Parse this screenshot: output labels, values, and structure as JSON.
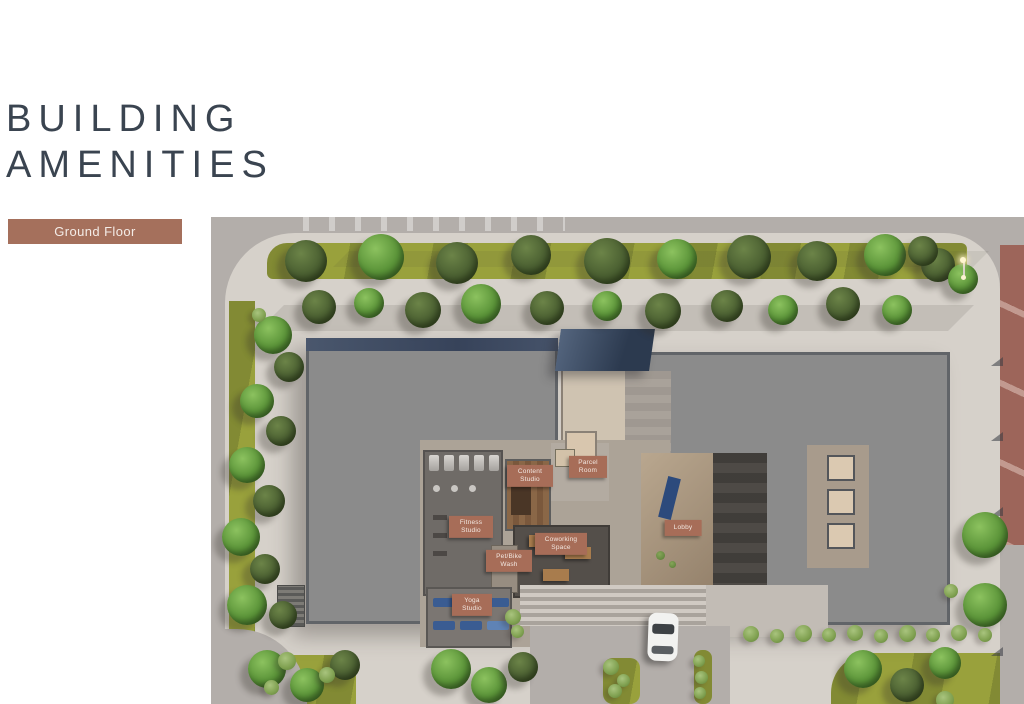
{
  "header": {
    "title_line1": "BUILDING",
    "title_line2": "AMENITIES"
  },
  "floor_selector": {
    "selected": "Ground Floor"
  },
  "site_plan": {
    "type": "aerial-render",
    "amenity_labels": [
      {
        "id": "content-studio",
        "text": "Content Studio"
      },
      {
        "id": "parcel-room",
        "text": "Parcel Room"
      },
      {
        "id": "fitness-studio",
        "text": "Fitness Studio"
      },
      {
        "id": "coworking-space",
        "text": "Coworking Space"
      },
      {
        "id": "pet-bike-wash",
        "text": "Pet/Bike Wash"
      },
      {
        "id": "yoga-studio",
        "text": "Yoga Studio"
      },
      {
        "id": "lobby",
        "text": "Lobby"
      }
    ]
  },
  "colors": {
    "accent_terracotta": "#A5705C",
    "title_text": "#3A4450",
    "label_background": "#A76D58",
    "building_roof": "#8B8B8B",
    "grass": "#99A13C",
    "sidewalk": "#D6D1CA",
    "road": "#B3AEAA",
    "side_road_red": "#9D655A"
  }
}
